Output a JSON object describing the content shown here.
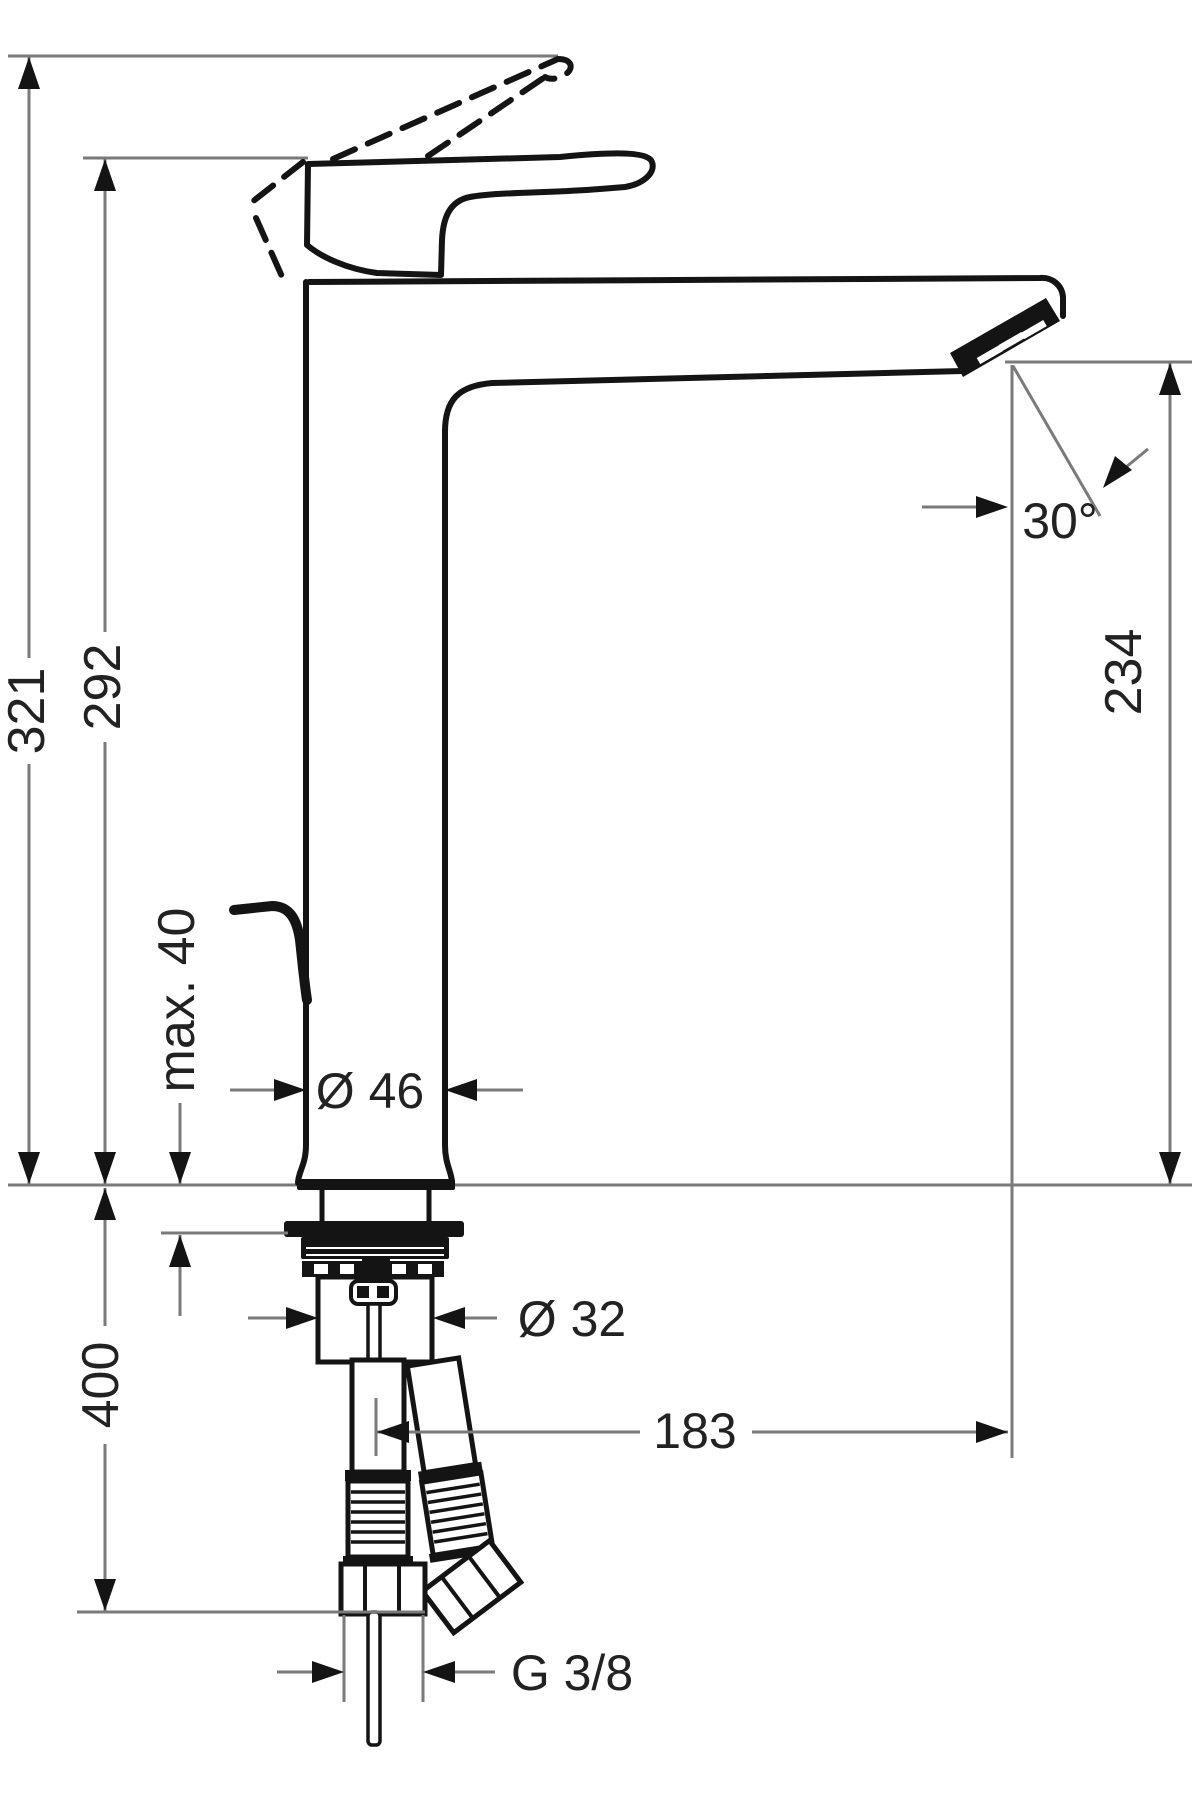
{
  "drawing": {
    "kind": "technical dimension drawing of single-lever tall basin mixer tap",
    "colors": {
      "background": "#ffffff",
      "outline": "#141414",
      "dimension_lines": "#7a7a7a",
      "text": "#222222"
    },
    "labels": {
      "total_height": "321",
      "deck_to_handle": "292",
      "outlet_height": "234",
      "outlet_angle": "30°",
      "max_deck_thickness": "max. 40",
      "body_diameter": "Ø 46",
      "shank_diameter": "Ø 32",
      "hose_length": "400",
      "spout_reach": "183",
      "connection_thread": "G 3/8"
    }
  }
}
